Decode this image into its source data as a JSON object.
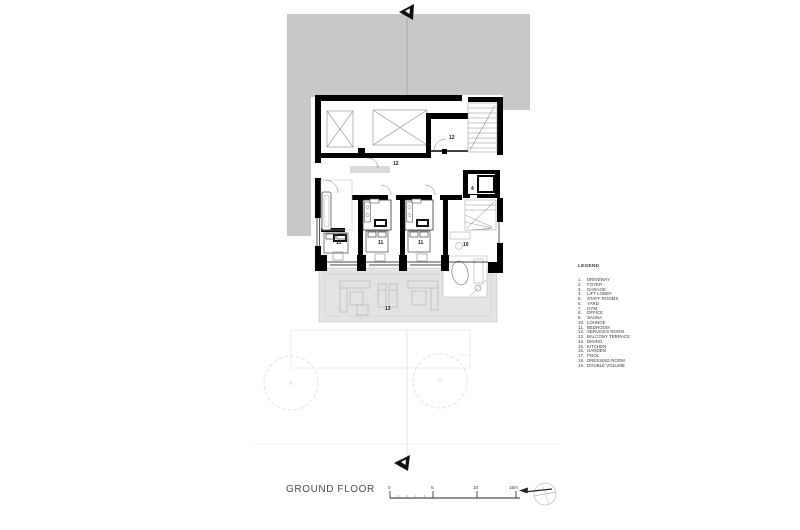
{
  "title": {
    "text": "GROUND FLOOR"
  },
  "legend": {
    "heading": "LEGEND",
    "items": [
      {
        "num": "1.",
        "name": "DRIVEWAY"
      },
      {
        "num": "2.",
        "name": "FOYER"
      },
      {
        "num": "3.",
        "name": "GARAGE"
      },
      {
        "num": "4.",
        "name": "LIFT LOBBY"
      },
      {
        "num": "5.",
        "name": "STAFF ROOMS"
      },
      {
        "num": "6.",
        "name": "YARD"
      },
      {
        "num": "7.",
        "name": "GYM"
      },
      {
        "num": "8.",
        "name": "OFFICE"
      },
      {
        "num": "9.",
        "name": "SAUNA"
      },
      {
        "num": "10.",
        "name": "LOUNGE"
      },
      {
        "num": "11.",
        "name": "BEDROOM"
      },
      {
        "num": "12.",
        "name": "SERVICES ROOM"
      },
      {
        "num": "13.",
        "name": "BALCONY TERRACE"
      },
      {
        "num": "14.",
        "name": "DINING"
      },
      {
        "num": "15.",
        "name": "KITCHEN"
      },
      {
        "num": "16.",
        "name": "GARDEN"
      },
      {
        "num": "17.",
        "name": "POOL"
      },
      {
        "num": "18.",
        "name": "DRESSING ROOM"
      },
      {
        "num": "19.",
        "name": "DOUBLE VOLUME"
      }
    ]
  },
  "plan": {
    "room_labels": [
      {
        "id": "services-room-upper",
        "text": "12"
      },
      {
        "id": "services-room-corridor",
        "text": "12"
      },
      {
        "id": "lift-lobby",
        "text": "4"
      },
      {
        "id": "bedroom-1",
        "text": "11"
      },
      {
        "id": "bedroom-2",
        "text": "11"
      },
      {
        "id": "bedroom-3",
        "text": "11"
      },
      {
        "id": "lounge",
        "text": "10"
      },
      {
        "id": "balcony-terrace",
        "text": "13"
      }
    ]
  },
  "scale_bar": {
    "labels": [
      "0",
      "5",
      "10",
      "15m"
    ]
  },
  "colors": {
    "driveway_gray": "#c8c8c8",
    "terrace_gray": "#e3e3e1",
    "wall_black": "#000000",
    "faint_line": "#ececec"
  }
}
